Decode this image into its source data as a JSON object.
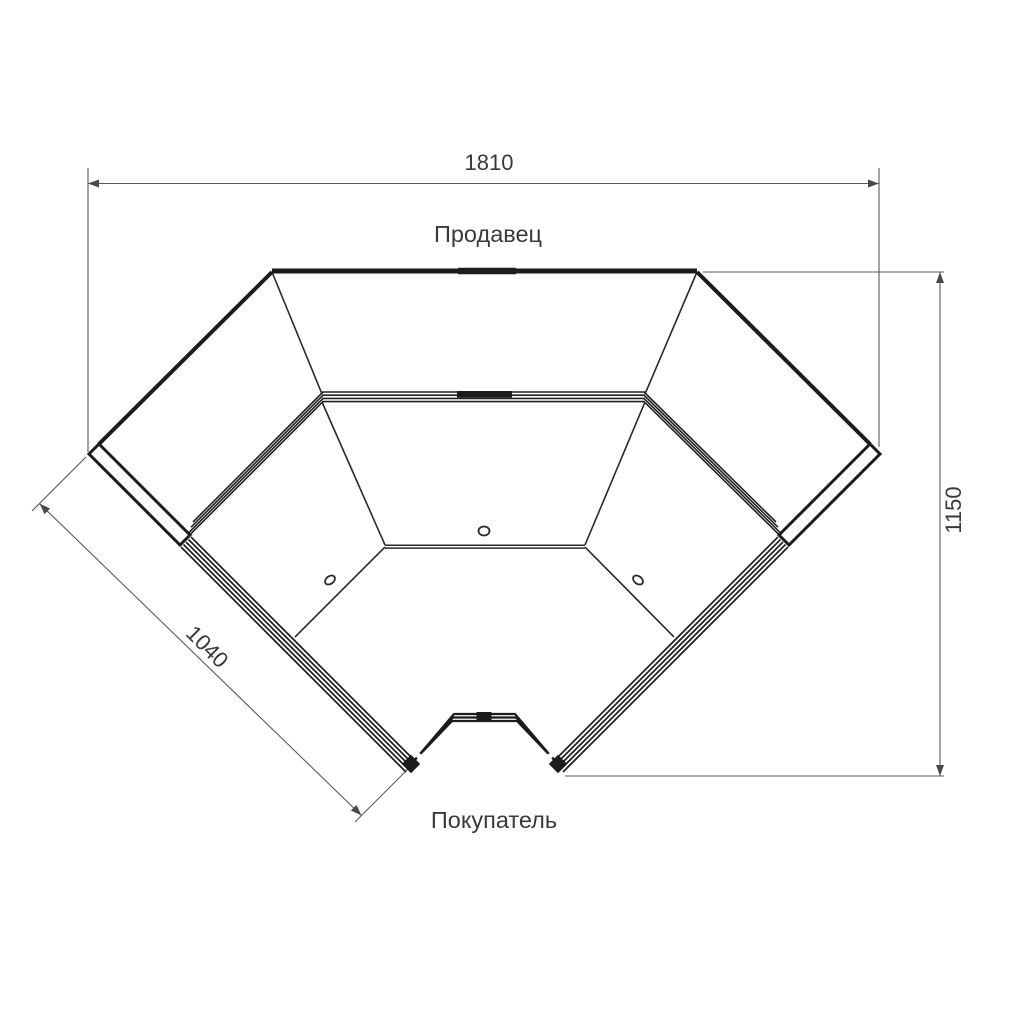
{
  "drawing": {
    "type": "corner-counter-plan-view",
    "labels": {
      "seller": "Продавец",
      "buyer": "Покупатель"
    },
    "dimensions": {
      "overall_width": "1810",
      "overall_depth": "1150",
      "front_section_length": "1040"
    },
    "colors": {
      "outline": "#1c1c1c",
      "thin_line": "#2a2a2a",
      "dimension_line": "#5a5a5a",
      "text": "#3a3a3a",
      "background": "#ffffff"
    }
  }
}
